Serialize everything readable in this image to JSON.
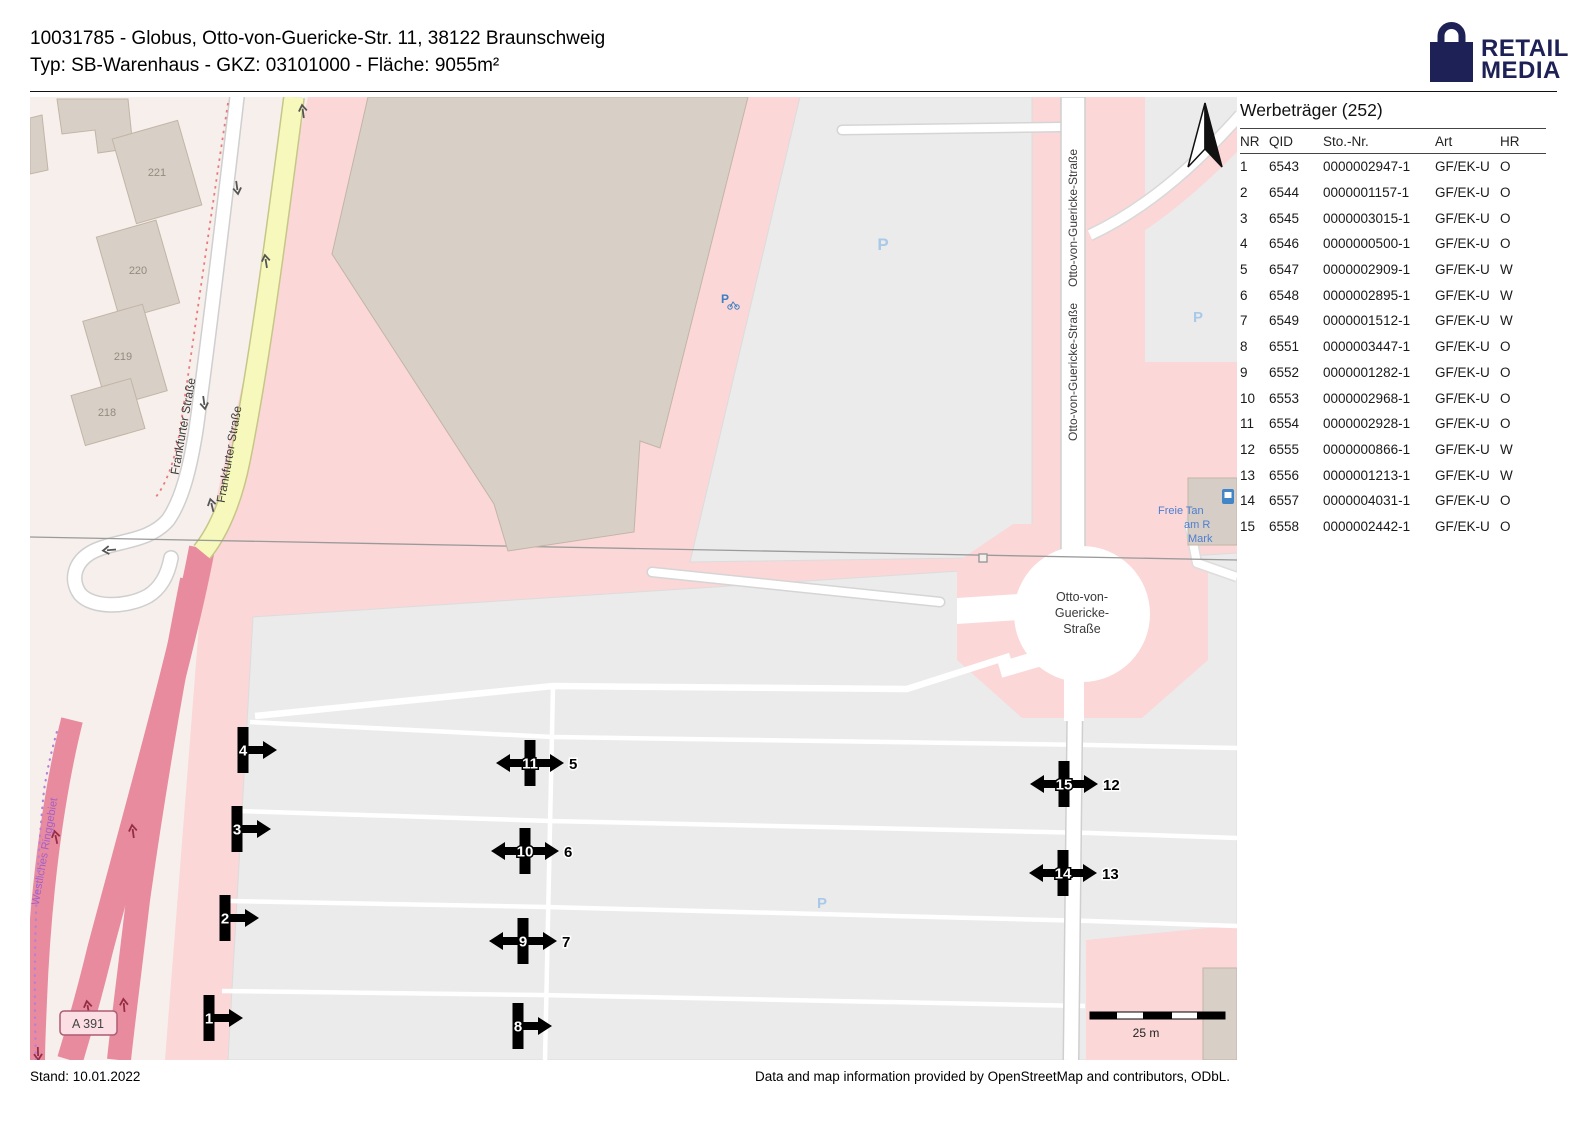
{
  "header": {
    "line1": "10031785 - Globus, Otto-von-Guericke-Str. 11, 38122 Braunschweig",
    "line2": "Typ: SB-Warenhaus - GKZ: 03101000 - Fläche: 9055m²"
  },
  "logo": {
    "line1": "RETAIL",
    "line2": "MEDIA"
  },
  "panel": {
    "title": "Werbeträger (252)",
    "columns": [
      "NR",
      "QID",
      "Sto.-Nr.",
      "Art",
      "HR"
    ],
    "rows": [
      [
        "1",
        "6543",
        "0000002947-1",
        "GF/EK-U",
        "O"
      ],
      [
        "2",
        "6544",
        "0000001157-1",
        "GF/EK-U",
        "O"
      ],
      [
        "3",
        "6545",
        "0000003015-1",
        "GF/EK-U",
        "O"
      ],
      [
        "4",
        "6546",
        "0000000500-1",
        "GF/EK-U",
        "O"
      ],
      [
        "5",
        "6547",
        "0000002909-1",
        "GF/EK-U",
        "W"
      ],
      [
        "6",
        "6548",
        "0000002895-1",
        "GF/EK-U",
        "W"
      ],
      [
        "7",
        "6549",
        "0000001512-1",
        "GF/EK-U",
        "W"
      ],
      [
        "8",
        "6551",
        "0000003447-1",
        "GF/EK-U",
        "O"
      ],
      [
        "9",
        "6552",
        "0000001282-1",
        "GF/EK-U",
        "O"
      ],
      [
        "10",
        "6553",
        "0000002968-1",
        "GF/EK-U",
        "O"
      ],
      [
        "11",
        "6554",
        "0000002928-1",
        "GF/EK-U",
        "O"
      ],
      [
        "12",
        "6555",
        "0000000866-1",
        "GF/EK-U",
        "W"
      ],
      [
        "13",
        "6556",
        "0000001213-1",
        "GF/EK-U",
        "W"
      ],
      [
        "14",
        "6557",
        "0000004031-1",
        "GF/EK-U",
        "O"
      ],
      [
        "15",
        "6558",
        "0000002442-1",
        "GF/EK-U",
        "O"
      ]
    ]
  },
  "map": {
    "street_labels": {
      "frankfurter": "Frankfurter Straße",
      "otto": "Otto-von-Guericke-Straße",
      "roundabout_lines": [
        "Otto-von-",
        "Guericke-",
        "Straße"
      ]
    },
    "building_numbers": [
      "221",
      "220",
      "219",
      "218"
    ],
    "district_label": "Westliches Ringgebiet",
    "motorway_ref": "A 391",
    "parking_symbol": "P",
    "fuel_label_lines": [
      "Freie Tan",
      "am R",
      "Mark"
    ],
    "scale_label": "25 m",
    "markers": [
      {
        "label": "1",
        "x": 209,
        "y": 1018,
        "double": false
      },
      {
        "label": "2",
        "x": 225,
        "y": 918,
        "double": false
      },
      {
        "label": "3",
        "x": 237,
        "y": 829,
        "double": false
      },
      {
        "label": "4",
        "x": 243,
        "y": 750,
        "double": false
      },
      {
        "label": "8",
        "x": 518,
        "y": 1026,
        "double": false
      },
      {
        "label": "11",
        "label2": "5",
        "x": 530,
        "y": 763,
        "double": true
      },
      {
        "label": "10",
        "label2": "6",
        "x": 525,
        "y": 851,
        "double": true
      },
      {
        "label": "9",
        "label2": "7",
        "x": 523,
        "y": 941,
        "double": true
      },
      {
        "label": "15",
        "label2": "12",
        "x": 1064,
        "y": 784,
        "double": true
      },
      {
        "label": "14",
        "label2": "13",
        "x": 1063,
        "y": 873,
        "double": true
      }
    ]
  },
  "footer": {
    "left": "Stand: 10.01.2022",
    "right": "Data and map information provided by OpenStreetMap and contributors, ODbL."
  },
  "colors": {
    "logo_navy": "#1e2156",
    "retail_pink": "#fbd7d7",
    "motorway_pink": "#e88b9e",
    "building_tan": "#d8cfc7",
    "parking_gray": "#ebebeb",
    "road_yellow": "#f6f9bb"
  }
}
